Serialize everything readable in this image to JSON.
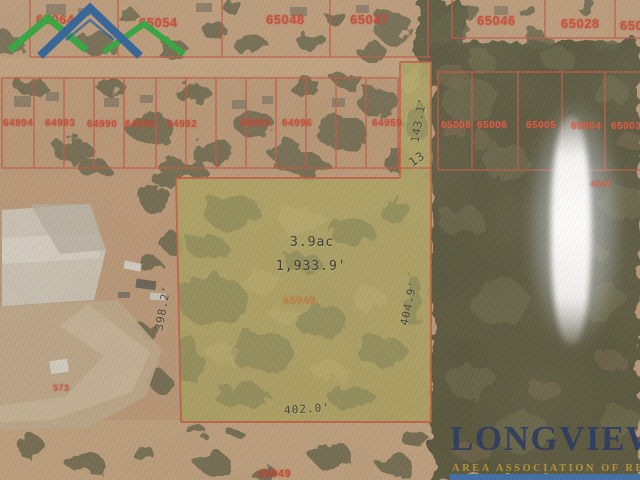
{
  "brand": {
    "name": "LONGVIEW",
    "tagline": "AREA ASSOCIATION OF REALTORS"
  },
  "subject_parcel": {
    "parcel_id": "65049",
    "area_label": "3.9ac",
    "perimeter_label": "1,933.9'",
    "dimensions": {
      "left": "398.2'",
      "right": "404.9'",
      "bottom": "402.0'",
      "strip_length": "143.1'",
      "strip_width": "13"
    }
  },
  "parcel_ids": {
    "top_row": [
      "65064",
      "65054",
      "65048",
      "65047",
      "65046",
      "65028",
      "65028"
    ],
    "middle_row_left": [
      "64994",
      "64993",
      "64990",
      "64992",
      "64992",
      "64995",
      "64996",
      "64959"
    ],
    "middle_row_right": [
      "65006",
      "65006",
      "65005",
      "65004",
      "65003"
    ],
    "other": {
      "right_edge": "4647",
      "bottom_left": "573",
      "bottom_center": "65049"
    }
  },
  "colors": {
    "boundary_red": "#d2422e",
    "subject_fill": "#b3aa5a",
    "logo_navy": "#26365c",
    "logo_green": "#2da23b",
    "logo_blue": "#2b5e93",
    "tagline_gold": "#b5922f",
    "footer_bar_blue": "#3d6ca5"
  }
}
